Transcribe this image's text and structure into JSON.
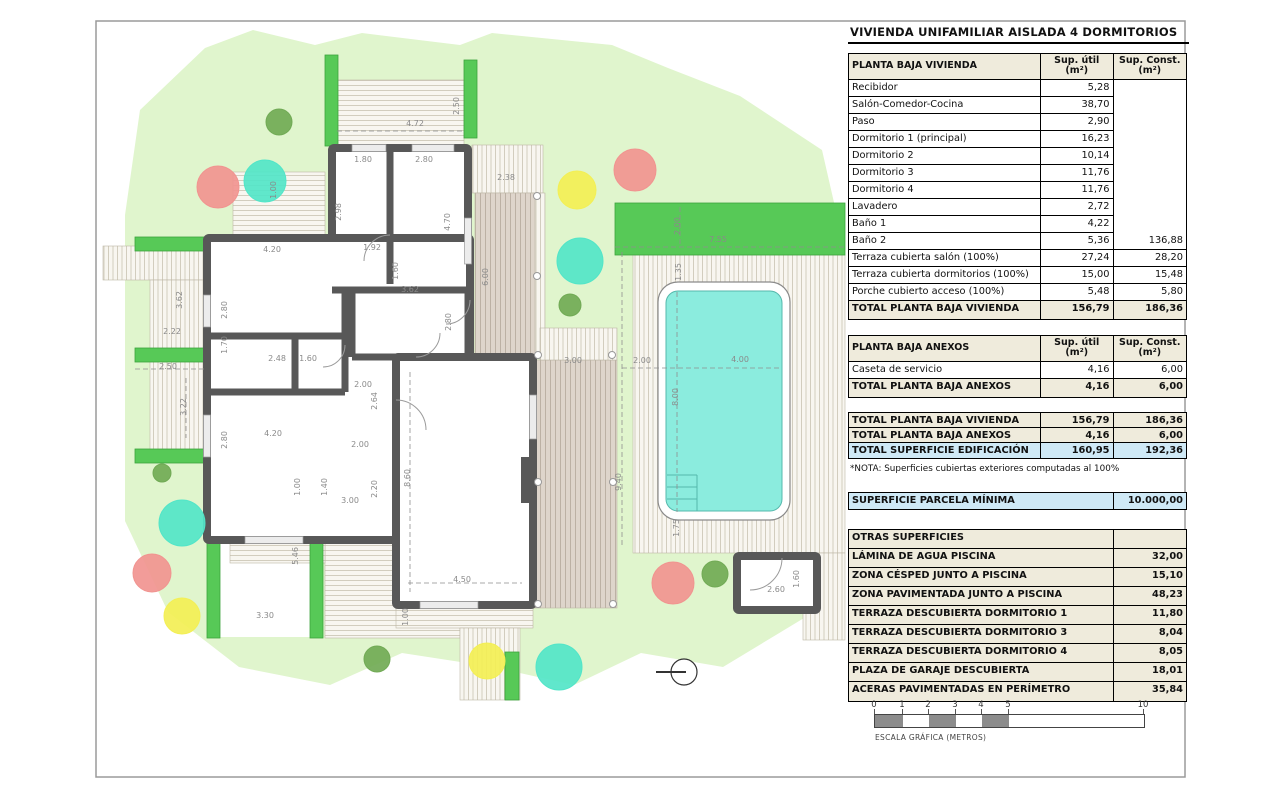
{
  "title": "VIVIENDA UNIFAMILIAR AISLADA 4 DORMITORIOS",
  "note": "*NOTA: Superficies cubiertas exteriores computadas al 100%",
  "columns": {
    "util_header": "Sup. útil\n(m²)",
    "const_header": "Sup. Const.\n(m²)"
  },
  "table_vivienda": {
    "header": "PLANTA BAJA VIVIENDA",
    "rows": [
      {
        "label": "Recibidor",
        "util": "5,28",
        "const": ""
      },
      {
        "label": "Salón-Comedor-Cocina",
        "util": "38,70",
        "const": ""
      },
      {
        "label": "Paso",
        "util": "2,90",
        "const": ""
      },
      {
        "label": "Dormitorio 1 (principal)",
        "util": "16,23",
        "const": ""
      },
      {
        "label": "Dormitorio 2",
        "util": "10,14",
        "const": ""
      },
      {
        "label": "Dormitorio 3",
        "util": "11,76",
        "const": ""
      },
      {
        "label": "Dormitorio 4",
        "util": "11,76",
        "const": ""
      },
      {
        "label": "Lavadero",
        "util": "2,72",
        "const": ""
      },
      {
        "label": "Baño 1",
        "util": "4,22",
        "const": ""
      },
      {
        "label": "Baño 2",
        "util": "5,36",
        "const": "136,88"
      },
      {
        "label": "Terraza cubierta salón (100%)",
        "util": "27,24",
        "const": "28,20"
      },
      {
        "label": "Terraza cubierta dormitorios (100%)",
        "util": "15,00",
        "const": "15,48"
      },
      {
        "label": "Porche cubierto acceso (100%)",
        "util": "5,48",
        "const": "5,80"
      }
    ],
    "total": {
      "label": "TOTAL PLANTA BAJA VIVIENDA",
      "util": "156,79",
      "const": "186,36"
    }
  },
  "table_anexos": {
    "header": "PLANTA BAJA ANEXOS",
    "rows": [
      {
        "label": "Caseta de servicio",
        "util": "4,16",
        "const": "6,00"
      }
    ],
    "total": {
      "label": "TOTAL PLANTA BAJA ANEXOS",
      "util": "4,16",
      "const": "6,00"
    }
  },
  "table_summary": {
    "rows": [
      {
        "label": "TOTAL PLANTA BAJA VIVIENDA",
        "util": "156,79",
        "const": "186,36",
        "style": "strong"
      },
      {
        "label": "TOTAL PLANTA BAJA ANEXOS",
        "util": "4,16",
        "const": "6,00",
        "style": "strong"
      },
      {
        "label": "TOTAL SUPERFICIE EDIFICACIÓN",
        "util": "160,95",
        "const": "192,36",
        "style": "blue"
      }
    ]
  },
  "table_parcela": {
    "label": "SUPERFICIE PARCELA MÍNIMA",
    "value": "10.000,00"
  },
  "table_otras": {
    "header": "OTRAS SUPERFICIES",
    "rows": [
      {
        "label": "LÁMINA DE AGUA PISCINA",
        "value": "32,00"
      },
      {
        "label": "ZONA CÉSPED JUNTO A PISCINA",
        "value": "15,10"
      },
      {
        "label": "ZONA PAVIMENTADA JUNTO A PISCINA",
        "value": "48,23"
      },
      {
        "label": "TERRAZA DESCUBIERTA DORMITORIO 1",
        "value": "11,80"
      },
      {
        "label": "TERRAZA DESCUBIERTA DORMITORIO 3",
        "value": "8,04"
      },
      {
        "label": "TERRAZA DESCUBIERTA DORMITORIO 4",
        "value": "8,05"
      },
      {
        "label": "PLAZA DE GARAJE DESCUBIERTA",
        "value": "18,01"
      },
      {
        "label": "ACERAS PAVIMENTADAS EN PERÍMETRO",
        "value": "35,84"
      }
    ]
  },
  "scale_bar": {
    "label": "ESCALA GRÁFICA (METROS)",
    "ticks": [
      {
        "t": "0",
        "px": 0
      },
      {
        "t": "1",
        "px": 28
      },
      {
        "t": "2",
        "px": 54
      },
      {
        "t": "3",
        "px": 81
      },
      {
        "t": "4",
        "px": 107
      },
      {
        "t": "5",
        "px": 134
      },
      {
        "t": "10",
        "px": 269
      }
    ],
    "segments": [
      {
        "w": 28,
        "f": "#8c8c8c"
      },
      {
        "w": 26,
        "f": "#ffffff"
      },
      {
        "w": 27,
        "f": "#8c8c8c"
      },
      {
        "w": 26,
        "f": "#ffffff"
      },
      {
        "w": 27,
        "f": "#8c8c8c"
      },
      {
        "w": 135,
        "f": "#ffffff"
      }
    ]
  },
  "plan": {
    "colors": {
      "frame": "#9a9a9a",
      "lawn": "#e0f5cd",
      "hedge": "#57c957",
      "hedge_border": "#3da33d",
      "wall": "#585858",
      "dim": "#8a8a8a",
      "pool_water": "#8becde",
      "pool_line": "#55b8ac",
      "hatch_bg": "#f8f6f0",
      "hatch_line": "#c9c3b2",
      "brown_bg": "#ded5cb",
      "brown_line": "#b3a89a",
      "tree_red": "#f19490",
      "tree_teal": "#52e5c8",
      "tree_yellow": "#f3ef55",
      "tree_green": "#71aa55"
    },
    "frame": {
      "x": 96,
      "y": 21,
      "w": 1089,
      "h": 756
    },
    "lawn_path": "M125,215 L140,110 L205,48 L253,30 L315,45 L362,33 L460,45 L492,33 L612,45 L668,68 L740,96 L822,150 L838,220 L845,300 L845,620 L814,612 L723,667 L641,653 L574,685 L493,667 L402,653 L330,685 L239,667 L168,612 L125,521 Z",
    "white_patches": [
      {
        "x": 220,
        "y": 489,
        "w": 90,
        "h": 148
      }
    ],
    "terraces": [
      {
        "x": 337,
        "y": 80,
        "w": 127,
        "h": 66,
        "pat": "h"
      },
      {
        "x": 233,
        "y": 172,
        "w": 92,
        "h": 64,
        "pat": "h"
      },
      {
        "x": 472,
        "y": 145,
        "w": 71,
        "h": 48,
        "pat": "v"
      },
      {
        "x": 475,
        "y": 193,
        "w": 62,
        "h": 162,
        "pat": "vb"
      },
      {
        "x": 535,
        "y": 193,
        "w": 10,
        "h": 162,
        "pat": "v"
      },
      {
        "x": 533,
        "y": 360,
        "w": 84,
        "h": 248,
        "pat": "vb"
      },
      {
        "x": 540,
        "y": 328,
        "w": 77,
        "h": 32,
        "pat": "v"
      },
      {
        "x": 633,
        "y": 255,
        "w": 212,
        "h": 298,
        "pat": "v"
      },
      {
        "x": 803,
        "y": 553,
        "w": 42,
        "h": 87,
        "pat": "v"
      },
      {
        "x": 103,
        "y": 246,
        "w": 102,
        "h": 34,
        "pat": "v"
      },
      {
        "x": 150,
        "y": 280,
        "w": 55,
        "h": 170,
        "pat": "v"
      },
      {
        "x": 325,
        "y": 505,
        "w": 135,
        "h": 133,
        "pat": "h"
      },
      {
        "x": 230,
        "y": 543,
        "w": 95,
        "h": 20,
        "pat": "h"
      },
      {
        "x": 396,
        "y": 608,
        "w": 137,
        "h": 20,
        "pat": "h"
      },
      {
        "x": 460,
        "y": 628,
        "w": 60,
        "h": 72,
        "pat": "v"
      },
      {
        "x": 312,
        "y": 462,
        "w": 88,
        "h": 68,
        "pat": "vb"
      }
    ],
    "hedges": [
      {
        "x": 325,
        "y": 55,
        "w": 13,
        "h": 91
      },
      {
        "x": 464,
        "y": 60,
        "w": 13,
        "h": 78
      },
      {
        "x": 615,
        "y": 203,
        "w": 230,
        "h": 52
      },
      {
        "x": 135,
        "y": 237,
        "w": 70,
        "h": 14
      },
      {
        "x": 135,
        "y": 348,
        "w": 70,
        "h": 14
      },
      {
        "x": 135,
        "y": 449,
        "w": 83,
        "h": 14
      },
      {
        "x": 207,
        "y": 488,
        "w": 13,
        "h": 150
      },
      {
        "x": 310,
        "y": 492,
        "w": 13,
        "h": 146
      },
      {
        "x": 505,
        "y": 652,
        "w": 14,
        "h": 48
      }
    ],
    "rooms": [
      {
        "x": 332,
        "y": 148,
        "w": 136,
        "h": 142
      },
      {
        "x": 207,
        "y": 238,
        "w": 263,
        "h": 302
      },
      {
        "x": 396,
        "y": 357,
        "w": 137,
        "h": 248
      },
      {
        "x": 737,
        "y": 556,
        "w": 80,
        "h": 54
      }
    ],
    "walls": [
      [
        390,
        148,
        390,
        284
      ],
      [
        207,
        336,
        345,
        336
      ],
      [
        207,
        392,
        345,
        392
      ],
      [
        295,
        336,
        295,
        392
      ],
      [
        345,
        290,
        345,
        392
      ],
      [
        352,
        290,
        352,
        357
      ],
      [
        352,
        357,
        396,
        357
      ],
      [
        332,
        290,
        468,
        290
      ],
      [
        468,
        290,
        468,
        357
      ]
    ],
    "pillars": [
      {
        "x": 521,
        "y": 457,
        "w": 14,
        "h": 46
      }
    ],
    "windows": [
      {
        "x": 352,
        "y": 144.5,
        "w": 34,
        "h": 7
      },
      {
        "x": 412,
        "y": 144.5,
        "w": 42,
        "h": 7
      },
      {
        "x": 464.5,
        "y": 218,
        "w": 7,
        "h": 46
      },
      {
        "x": 203.5,
        "y": 295,
        "w": 7,
        "h": 32
      },
      {
        "x": 203.5,
        "y": 415,
        "w": 7,
        "h": 42
      },
      {
        "x": 245,
        "y": 536.5,
        "w": 58,
        "h": 7
      },
      {
        "x": 420,
        "y": 601.5,
        "w": 58,
        "h": 7
      },
      {
        "x": 529.5,
        "y": 395,
        "w": 7,
        "h": 44
      }
    ],
    "doors": [
      "M390,235 A26 26 0 0 0 364,261",
      "M345,345 A22 22 0 0 1 323,367",
      "M396,400 A30 30 0 0 1 426,430",
      "M470,300 A24 24 0 0 1 446,324",
      "M416,357 A24 24 0 0 0 440,333",
      "M782,558 A32 32 0 0 1 750,590"
    ],
    "pool": {
      "outer": {
        "x": 658,
        "y": 282,
        "w": 132,
        "h": 238,
        "rx": 20
      },
      "inner": {
        "x": 666,
        "y": 291,
        "w": 116,
        "h": 220,
        "rx": 12
      },
      "steps_h": [
        475,
        487,
        499
      ],
      "steps_x1": 667,
      "steps_x2": 697,
      "steps_y1": 475,
      "steps_y2": 511
    },
    "columns_dots": [
      {
        "x": 537,
        "y": 196
      },
      {
        "x": 537,
        "y": 276
      },
      {
        "x": 538,
        "y": 355
      },
      {
        "x": 612,
        "y": 355
      },
      {
        "x": 538,
        "y": 482
      },
      {
        "x": 613,
        "y": 482
      },
      {
        "x": 538,
        "y": 604
      },
      {
        "x": 613,
        "y": 604
      }
    ],
    "dashed": [
      [
        615,
        247,
        845,
        247
      ],
      [
        680,
        207,
        680,
        247
      ],
      [
        622,
        368,
        781,
        368
      ],
      [
        677,
        292,
        677,
        512
      ],
      [
        135,
        369,
        205,
        369
      ],
      [
        186,
        378,
        186,
        438
      ],
      [
        337,
        131,
        464,
        131
      ],
      [
        622,
        252,
        622,
        548
      ],
      [
        410,
        372,
        410,
        592
      ],
      [
        408,
        583,
        522,
        583
      ]
    ],
    "trees": [
      {
        "c": "tree_green",
        "x": 279,
        "y": 122,
        "r": 13
      },
      {
        "c": "tree_red",
        "x": 218,
        "y": 187,
        "r": 21
      },
      {
        "c": "tree_teal",
        "x": 265,
        "y": 181,
        "r": 21
      },
      {
        "c": "tree_yellow",
        "x": 577,
        "y": 190,
        "r": 19
      },
      {
        "c": "tree_red",
        "x": 635,
        "y": 170,
        "r": 21
      },
      {
        "c": "tree_teal",
        "x": 580,
        "y": 261,
        "r": 23
      },
      {
        "c": "tree_green",
        "x": 570,
        "y": 305,
        "r": 11
      },
      {
        "c": "tree_green",
        "x": 162,
        "y": 473,
        "r": 9
      },
      {
        "c": "tree_teal",
        "x": 182,
        "y": 523,
        "r": 23
      },
      {
        "c": "tree_red",
        "x": 152,
        "y": 573,
        "r": 19
      },
      {
        "c": "tree_yellow",
        "x": 182,
        "y": 616,
        "r": 18
      },
      {
        "c": "tree_green",
        "x": 377,
        "y": 659,
        "r": 13
      },
      {
        "c": "tree_yellow",
        "x": 487,
        "y": 661,
        "r": 18
      },
      {
        "c": "tree_red",
        "x": 673,
        "y": 583,
        "r": 21
      },
      {
        "c": "tree_green",
        "x": 715,
        "y": 574,
        "r": 13
      },
      {
        "c": "tree_teal",
        "x": 559,
        "y": 667,
        "r": 23
      }
    ],
    "compass": {
      "cx": 684,
      "cy": 672,
      "r": 13,
      "x1": 656,
      "y1": 672,
      "x2": 686,
      "y2": 672
    },
    "dimensions": [
      {
        "t": "4.72",
        "x": 415,
        "y": 126,
        "r": 0
      },
      {
        "t": "2.50",
        "x": 459,
        "y": 106,
        "r": 1
      },
      {
        "t": "1.00",
        "x": 276,
        "y": 190,
        "r": 1
      },
      {
        "t": "1.80",
        "x": 363,
        "y": 162,
        "r": 0
      },
      {
        "t": "2.80",
        "x": 424,
        "y": 162,
        "r": 0
      },
      {
        "t": "2.98",
        "x": 341,
        "y": 212,
        "r": 1
      },
      {
        "t": "4.70",
        "x": 450,
        "y": 222,
        "r": 1
      },
      {
        "t": "1.92",
        "x": 372,
        "y": 250,
        "r": 0
      },
      {
        "t": "1.60",
        "x": 398,
        "y": 271,
        "r": 1
      },
      {
        "t": "2.38",
        "x": 506,
        "y": 180,
        "r": 0
      },
      {
        "t": "6.00",
        "x": 488,
        "y": 277,
        "r": 1
      },
      {
        "t": "2.00",
        "x": 680,
        "y": 226,
        "r": 1
      },
      {
        "t": "7.55",
        "x": 718,
        "y": 242,
        "r": 0
      },
      {
        "t": "1.35",
        "x": 681,
        "y": 272,
        "r": 1
      },
      {
        "t": "4.20",
        "x": 272,
        "y": 252,
        "r": 0
      },
      {
        "t": "2.80",
        "x": 227,
        "y": 310,
        "r": 1
      },
      {
        "t": "3.62",
        "x": 182,
        "y": 300,
        "r": 1
      },
      {
        "t": "2.22",
        "x": 172,
        "y": 334,
        "r": 0
      },
      {
        "t": "1.70",
        "x": 227,
        "y": 345,
        "r": 1
      },
      {
        "t": "2.48",
        "x": 277,
        "y": 361,
        "r": 0
      },
      {
        "t": "1.60",
        "x": 308,
        "y": 361,
        "r": 0
      },
      {
        "t": "2.50",
        "x": 168,
        "y": 369,
        "r": 0
      },
      {
        "t": "3.22",
        "x": 186,
        "y": 407,
        "r": 1
      },
      {
        "t": "2.80",
        "x": 227,
        "y": 440,
        "r": 1
      },
      {
        "t": "4.20",
        "x": 273,
        "y": 436,
        "r": 0
      },
      {
        "t": "3.62",
        "x": 410,
        "y": 292,
        "r": 0
      },
      {
        "t": "2.80",
        "x": 451,
        "y": 322,
        "r": 1
      },
      {
        "t": "2.00",
        "x": 363,
        "y": 387,
        "r": 0
      },
      {
        "t": "2.64",
        "x": 377,
        "y": 401,
        "r": 1
      },
      {
        "t": "2.00",
        "x": 360,
        "y": 447,
        "r": 0
      },
      {
        "t": "1.00",
        "x": 300,
        "y": 487,
        "r": 1
      },
      {
        "t": "1.40",
        "x": 327,
        "y": 487,
        "r": 1
      },
      {
        "t": "2.20",
        "x": 377,
        "y": 489,
        "r": 1
      },
      {
        "t": "3.00",
        "x": 350,
        "y": 503,
        "r": 0
      },
      {
        "t": "8.60",
        "x": 410,
        "y": 478,
        "r": 1
      },
      {
        "t": "4.50",
        "x": 462,
        "y": 582,
        "r": 0
      },
      {
        "t": "1.00",
        "x": 408,
        "y": 617,
        "r": 1
      },
      {
        "t": "5.46",
        "x": 298,
        "y": 556,
        "r": 1
      },
      {
        "t": "3.30",
        "x": 265,
        "y": 618,
        "r": 0
      },
      {
        "t": "3.00",
        "x": 573,
        "y": 363,
        "r": 0
      },
      {
        "t": "2.00",
        "x": 642,
        "y": 363,
        "r": 0
      },
      {
        "t": "4.00",
        "x": 740,
        "y": 362,
        "r": 0
      },
      {
        "t": "8.00",
        "x": 678,
        "y": 397,
        "r": 1
      },
      {
        "t": "9.40",
        "x": 621,
        "y": 482,
        "r": 1
      },
      {
        "t": "1.75",
        "x": 679,
        "y": 528,
        "r": 1
      },
      {
        "t": "2.60",
        "x": 776,
        "y": 592,
        "r": 0
      },
      {
        "t": "1.60",
        "x": 799,
        "y": 579,
        "r": 1
      }
    ]
  }
}
